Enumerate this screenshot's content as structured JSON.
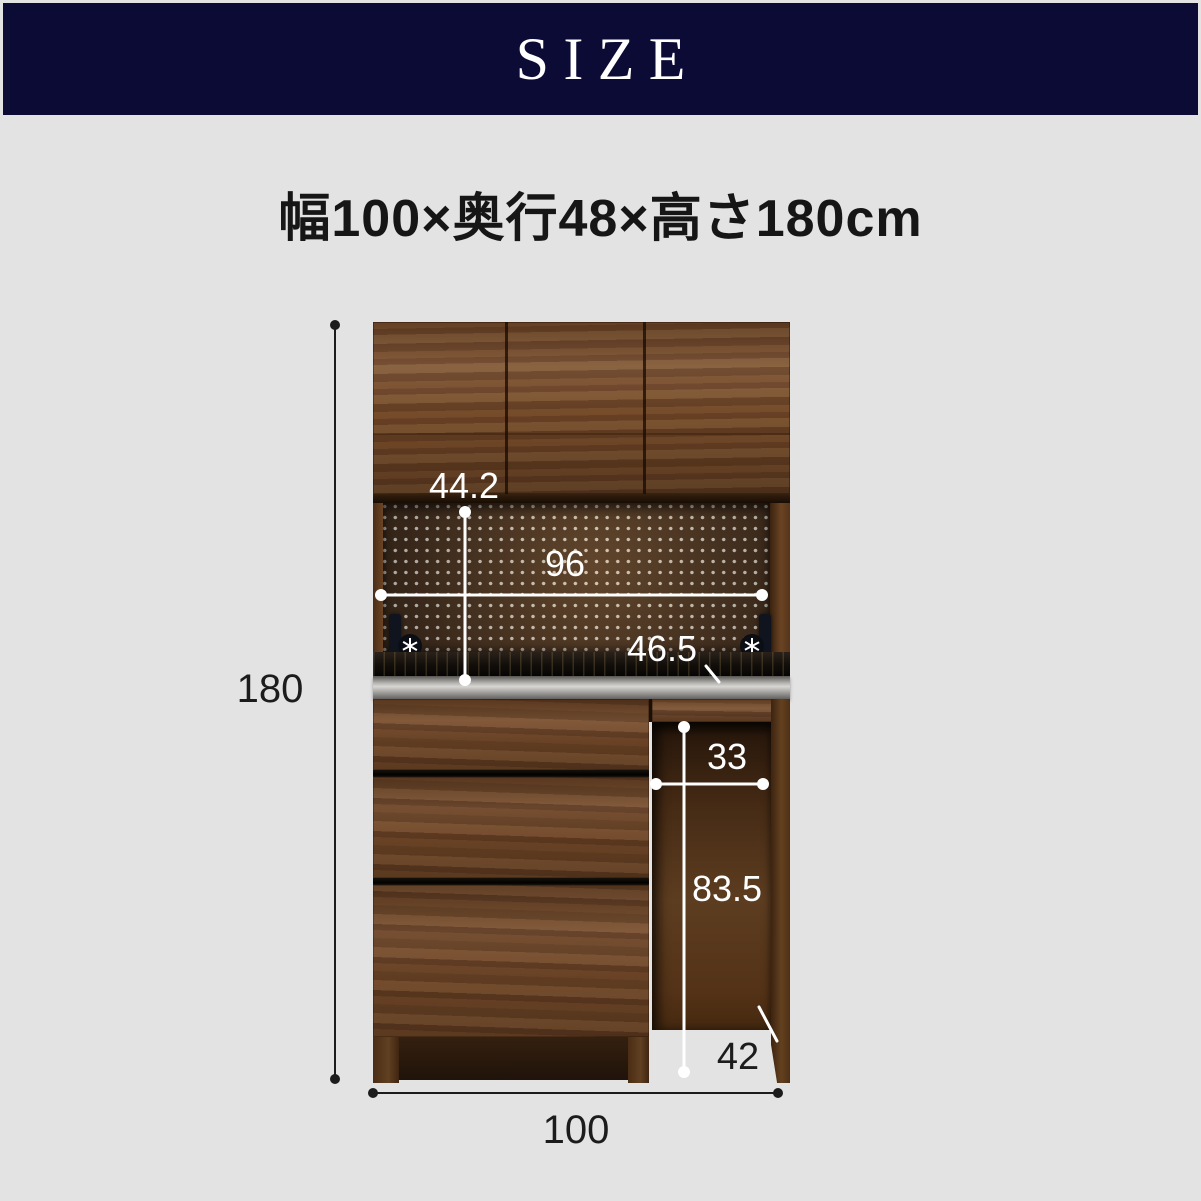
{
  "header": {
    "label": "SIZE"
  },
  "subtitle": {
    "text": "幅100×奥行48×高さ180cm"
  },
  "diagram": {
    "labels": {
      "total_height": "180",
      "total_width": "100",
      "hutch_inner_height": "44.2",
      "hutch_inner_width": "96",
      "counter_height": "46.5",
      "knee_space_width": "33",
      "knee_space_height": "83.5",
      "base_depth": "42"
    }
  },
  "colors": {
    "background": "#e3e3e4",
    "header_background": "#0b0b36",
    "header_text": "#ffffff",
    "wood_accent": "#6f4627",
    "dim_line_dark": "#1c1c1c",
    "dim_line_light": "#ffffff"
  }
}
